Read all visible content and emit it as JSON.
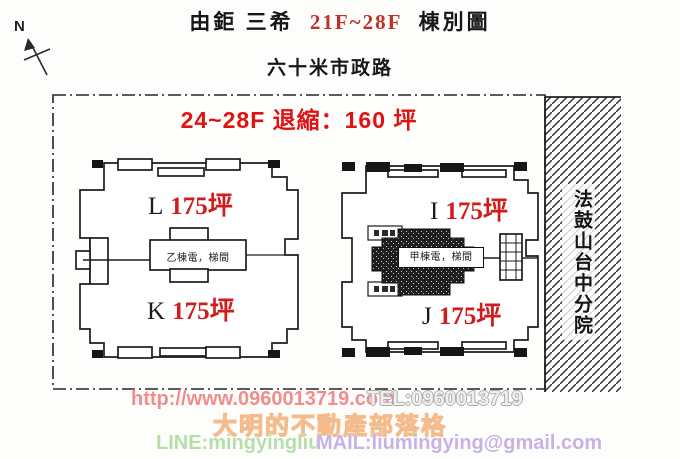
{
  "page": {
    "title_prefix": "由鉅 三希",
    "title_floors": "21F~28F",
    "title_suffix": "棟別圖",
    "road_label": "六十米市政路",
    "compass_label": "N",
    "setback_note": "24~28F 退縮：160 坪",
    "neighbor_label": "法鼓山台中分院"
  },
  "buildings": {
    "left": {
      "core_label": "乙棟電，梯間",
      "units": [
        {
          "letter": "L",
          "area": "175坪"
        },
        {
          "letter": "K",
          "area": "175坪"
        }
      ]
    },
    "right": {
      "core_label": "甲棟電，梯間",
      "units": [
        {
          "letter": "I",
          "area": "175坪"
        },
        {
          "letter": "J",
          "area": "175坪"
        }
      ]
    }
  },
  "watermark": {
    "url": "http://www.0960013719.com",
    "tel": "TEL:0960013719",
    "blog": "大明的不動產部落格",
    "line_id": "LINE:mingyingliu",
    "mail": "MAIL:liumingying@gmail.com"
  },
  "colors": {
    "accent_red": "#e01313",
    "unit_red": "#cf1d1d",
    "line_ink": "#1d1d1d",
    "wm_pink": "#f08d8d",
    "wm_gray": "#ededed",
    "wm_orange": "#f4bc8c",
    "wm_green": "#b5dfa9",
    "wm_violet": "#c7b2e6"
  }
}
